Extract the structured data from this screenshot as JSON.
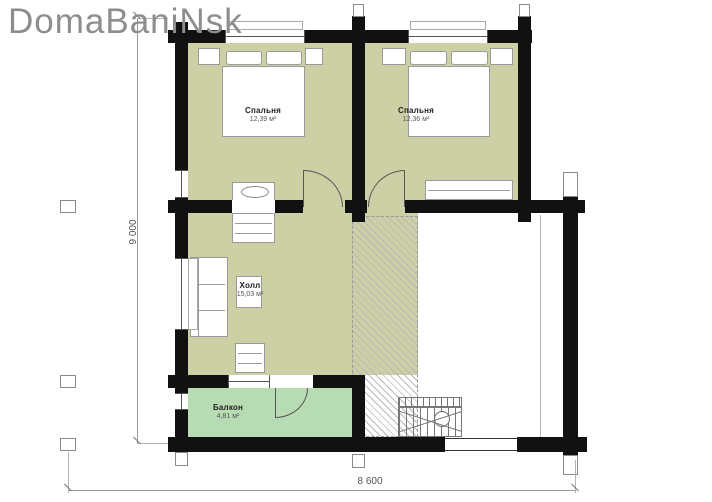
{
  "logo": {
    "text": "DomaBaniNsk"
  },
  "rooms": {
    "bedroom_left": {
      "name": "Спальня",
      "area": "12,39 м²"
    },
    "bedroom_right": {
      "name": "Спальня",
      "area": "12,36 м²"
    },
    "hall": {
      "name": "Холл",
      "area": "15,03 м²"
    },
    "balcony": {
      "name": "Балкон",
      "area": "4,81 м²"
    }
  },
  "dimensions": {
    "vertical": "9 000",
    "horizontal": "8 600"
  },
  "colors": {
    "wall": "#111111",
    "floor": "#cdcfa5",
    "balcony_floor": "#b7dbb2"
  }
}
